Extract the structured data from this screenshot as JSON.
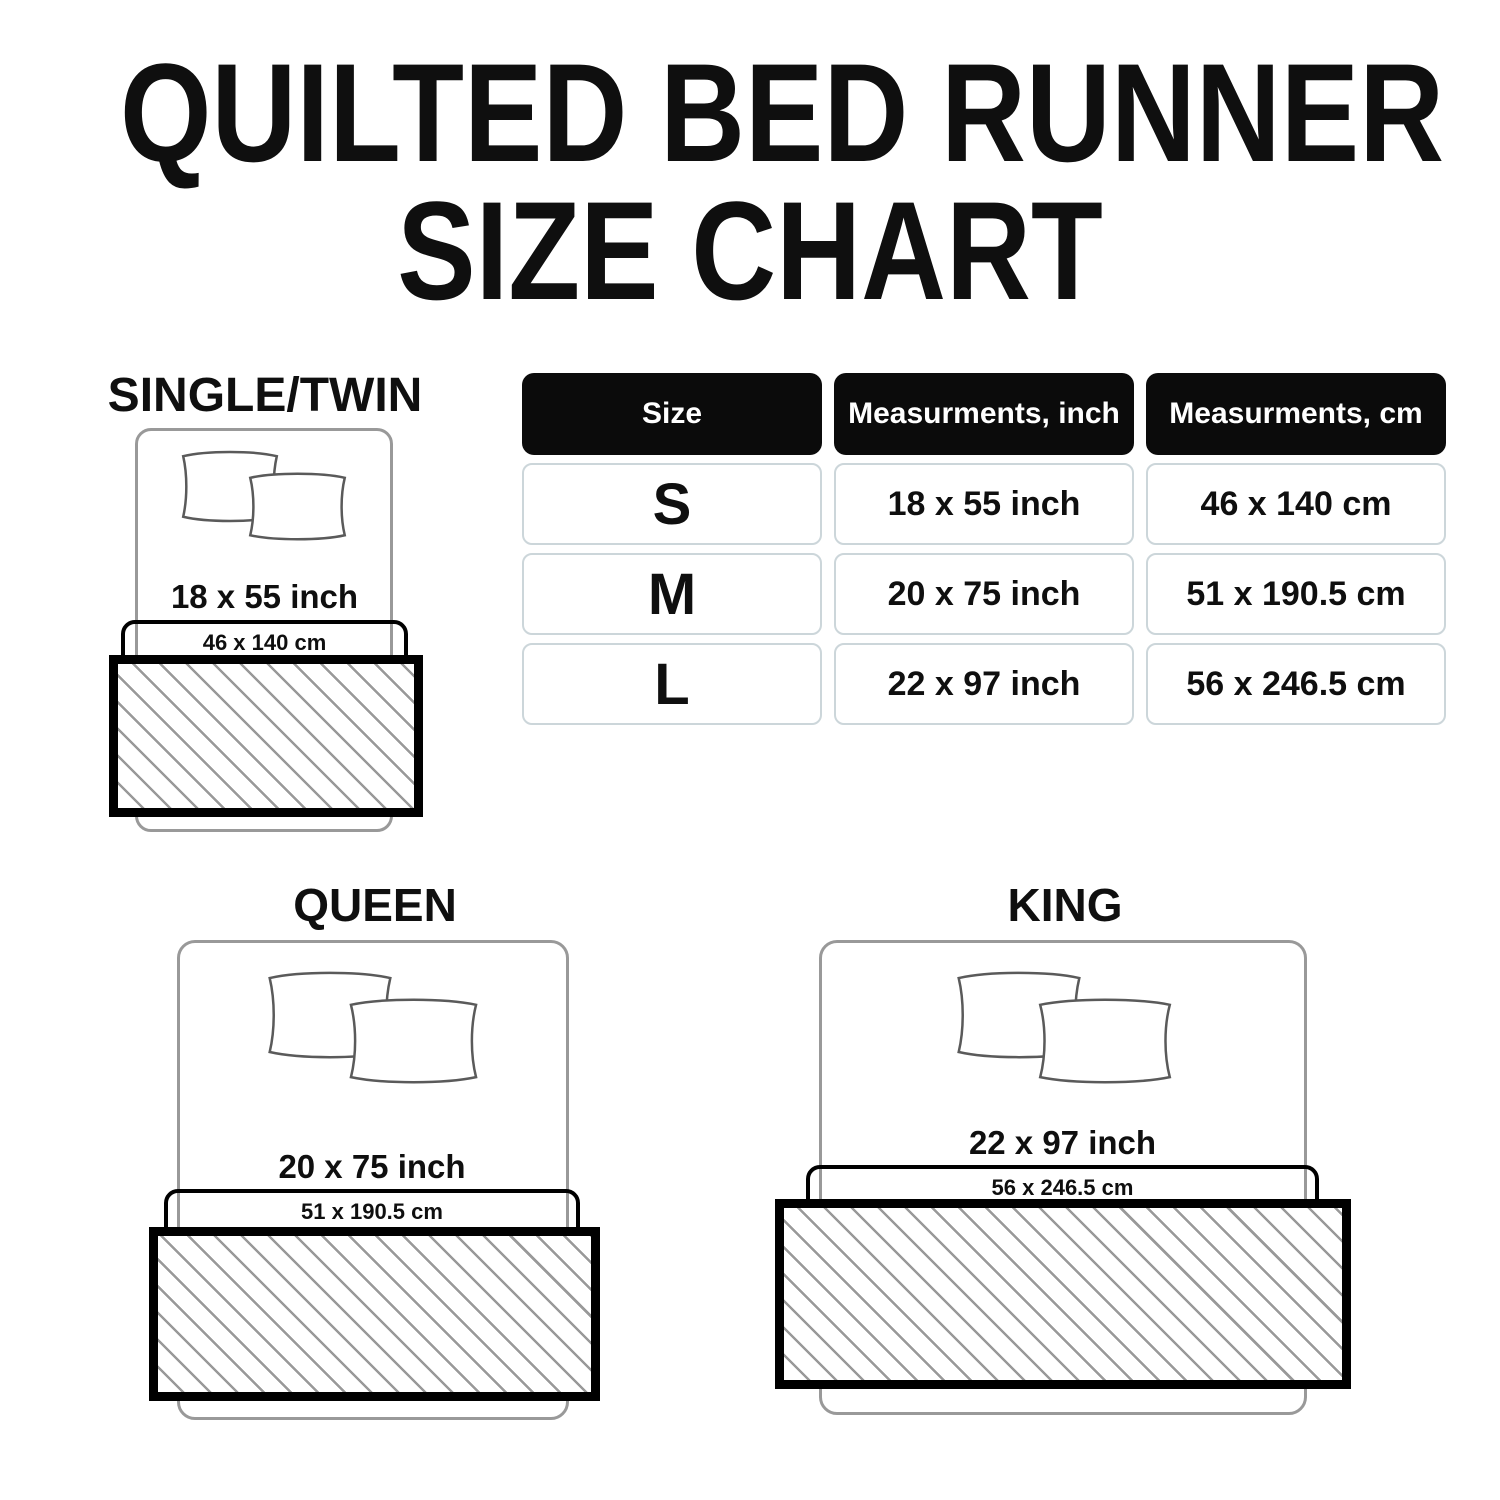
{
  "title": {
    "line1": "QUILTED BED RUNNER",
    "line2": "SIZE CHART"
  },
  "table": {
    "headers": [
      "Size",
      "Measurments, inch",
      "Measurments, cm"
    ],
    "rows": [
      {
        "size": "S",
        "inch": "18 x 55 inch",
        "cm": "46 x 140 cm"
      },
      {
        "size": "M",
        "inch": "20 x 75 inch",
        "cm": "51 x 190.5 cm"
      },
      {
        "size": "L",
        "inch": "22 x 97 inch",
        "cm": "56 x 246.5 cm"
      }
    ]
  },
  "diagrams": [
    {
      "name": "SINGLE/TWIN",
      "inch": "18 x 55 inch",
      "cm": "46 x 140 cm"
    },
    {
      "name": "QUEEN",
      "inch": "20 x 75 inch",
      "cm": "51 x 190.5 cm"
    },
    {
      "name": "KING",
      "inch": "22 x 97 inch",
      "cm": "56 x 246.5 cm"
    }
  ],
  "colors": {
    "text": "#0f0f0f",
    "header_bg": "#0b0b0b",
    "header_text": "#ffffff",
    "cell_border": "#ccd6da",
    "bed_outline": "#999999",
    "pillow_outline": "#5a5a5a",
    "hatch_line": "#999999",
    "runner_border": "#000000"
  }
}
